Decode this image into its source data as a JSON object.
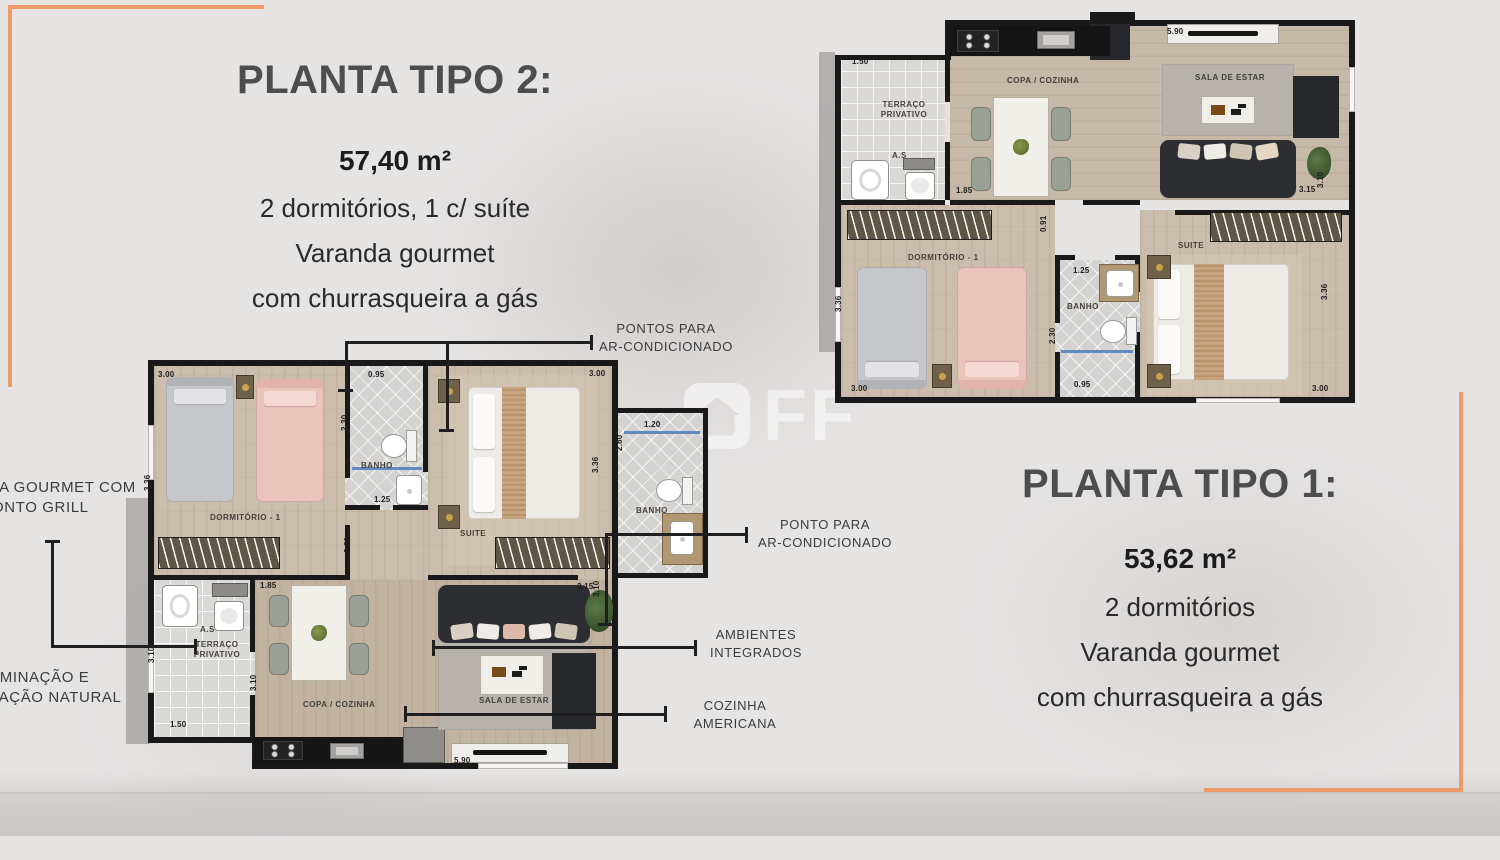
{
  "colors": {
    "accent": "#f09a6a",
    "heading": "#4d4d4d",
    "body_text": "#2a2a2a",
    "annotation_text": "#3c3c3c",
    "wall": "#191919",
    "background": "#e6e4e3"
  },
  "panel_tipo2": {
    "title": "PLANTA TIPO 2:",
    "area": "57,40 m²",
    "line1": "2 dormitórios, 1 c/ suíte",
    "line2": "Varanda gourmet",
    "line3": "com churrasqueira a gás"
  },
  "panel_tipo1": {
    "title": "PLANTA TIPO 1:",
    "area": "53,62 m²",
    "line1": "2 dormitórios",
    "line2": "Varanda gourmet",
    "line3": "com churrasqueira a gás"
  },
  "watermark": {
    "icon": "house-icon",
    "text": "FF"
  },
  "callouts": {
    "pontos": {
      "line1": "PONTOS PARA",
      "line2": "AR-CONDICIONADO"
    },
    "ponto": {
      "line1": "PONTO PARA",
      "line2": "AR-CONDICIONADO"
    },
    "ambientes": {
      "line1": "AMBIENTES",
      "line2": "INTEGRADOS"
    },
    "cozinha": {
      "line1": "COZINHA",
      "line2": "AMERICANA"
    },
    "varanda": {
      "line1": "VARANDA GOURMET COM",
      "line2": "PONTO GRILL"
    },
    "iluminacao": {
      "line1": "ILUMINAÇÃO E",
      "line2": "VENTILAÇÃO NATURAL"
    }
  },
  "plan2": {
    "labels": {
      "dim_dorm_w": "3.00",
      "dim_dorm_h": "3.36",
      "room_dorm": "DORMITÓRIO - 1",
      "dim_banho1_w": "0.95",
      "dim_banho1_h": "2.30",
      "room_banho1": "BANHO",
      "dim_banho1_b": "1.25",
      "dim_suite_w": "3.00",
      "dim_suite_h": "3.36",
      "room_suite": "SUITE",
      "dim_corridor": "0.91",
      "dim_banho2_w": "1.20",
      "dim_banho2_h": "2.60",
      "room_banho2": "BANHO",
      "dim_sala_a": "3.15",
      "dim_sala_b": "3.10",
      "label_as": "A.S",
      "room_terraco_1": "TERRAÇO",
      "room_terraco_2": "PRIVATIVO",
      "dim_terraco_h": "3.10",
      "dim_terraco_w": "1.50",
      "dim_copa_t": "1.85",
      "dim_copa_h": "3.10",
      "room_copa": "COPA / COZINHA",
      "room_sala": "SALA DE ESTAR",
      "dim_bottom": "5.90"
    }
  },
  "plan1": {
    "labels": {
      "dim_terraco_w": "1.50",
      "dim_terraco_h": "3.10",
      "room_terraco_1": "TERRAÇO",
      "room_terraco_2": "PRIVATIVO",
      "label_as": "A.S",
      "dim_copa_t": "1.85",
      "room_copa": "COPA / COZINHA",
      "dim_sala_t": "5.90",
      "room_sala": "SALA DE ESTAR",
      "dim_sala_a": "3.15",
      "dim_sala_b": "3.10",
      "room_dorm": "DORMITÓRIO - 1",
      "dim_corridor": "0.91",
      "dim_dorm_h": "3.36",
      "dim_dorm_w": "3.00",
      "dim_banho_t": "1.25",
      "room_banho": "BANHO",
      "dim_banho_h": "2.30",
      "dim_banho_b": "0.95",
      "room_suite": "SUITE",
      "dim_suite_h": "3.36",
      "dim_suite_w": "3.00"
    }
  }
}
